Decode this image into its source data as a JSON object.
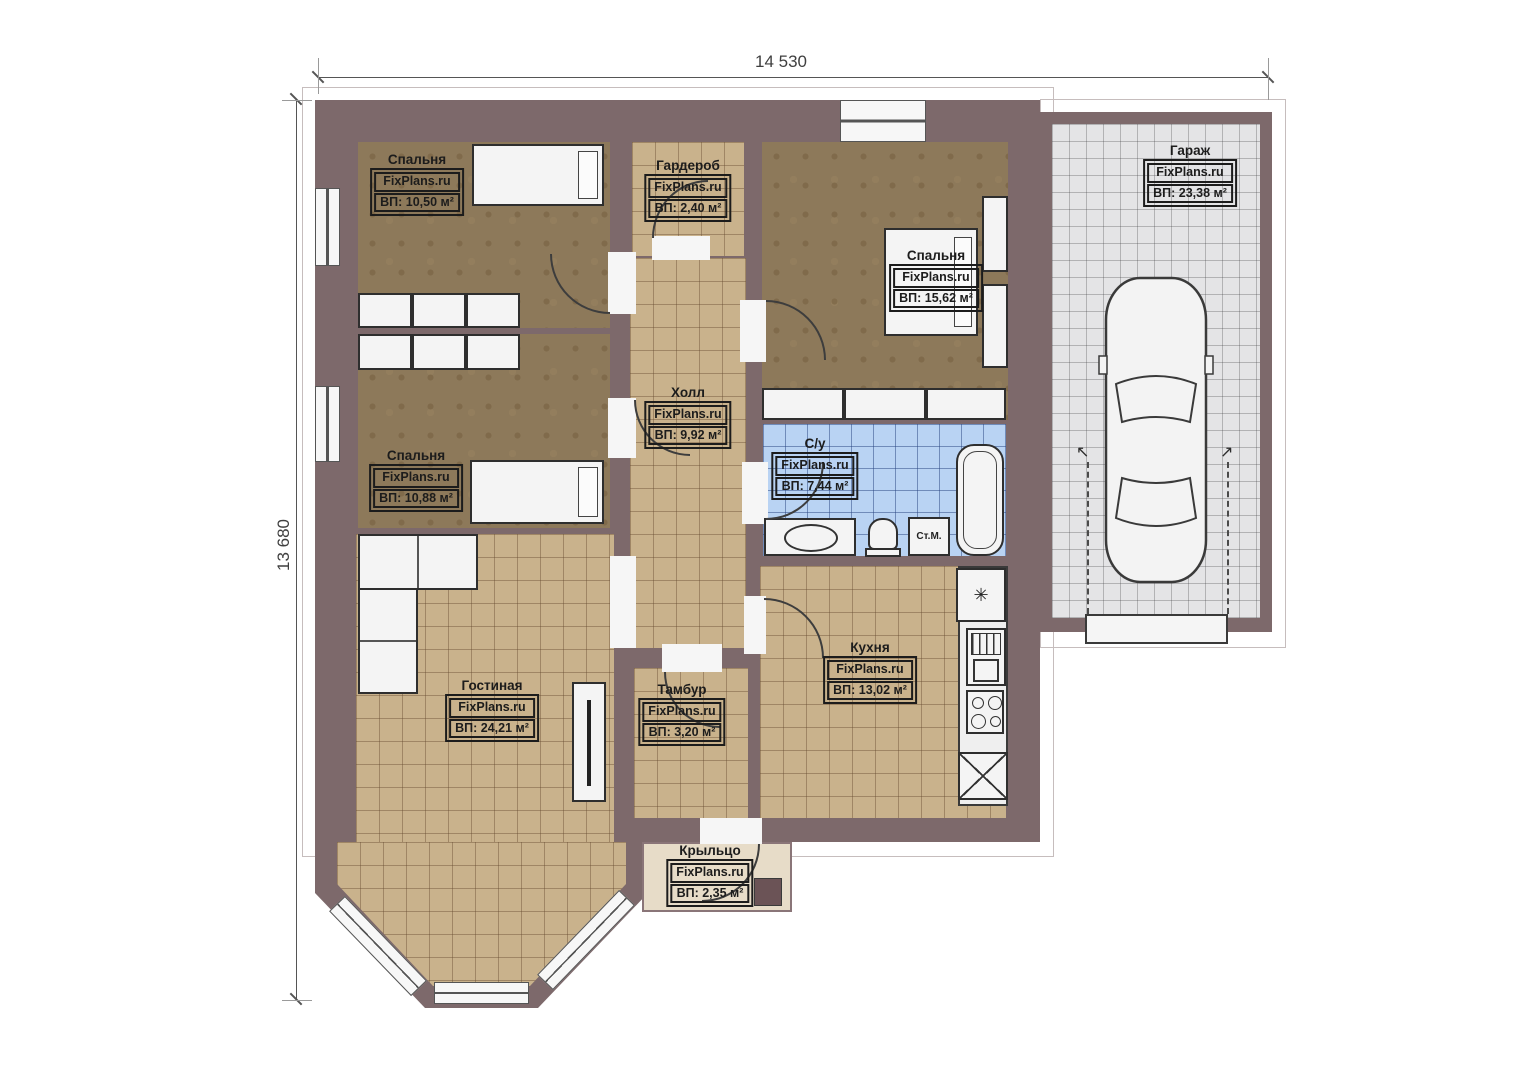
{
  "watermark": "FixPlans.ru",
  "dimension_labels": {
    "top": "14 530",
    "left": "13 680"
  },
  "rooms": [
    {
      "id": "bedroom-1",
      "name": "Спальня",
      "area": "ВП: 10,50 м²"
    },
    {
      "id": "wardrobe",
      "name": "Гардероб",
      "area": "ВП: 2,40 м²"
    },
    {
      "id": "bedroom-2",
      "name": "Спальня",
      "area": "ВП: 15,62 м²"
    },
    {
      "id": "garage",
      "name": "Гараж",
      "area": "ВП: 23,38 м²"
    },
    {
      "id": "hall",
      "name": "Холл",
      "area": "ВП: 9,92 м²"
    },
    {
      "id": "bathroom",
      "name": "С/у",
      "area": "ВП: 7,44 м²"
    },
    {
      "id": "bedroom-3",
      "name": "Спальня",
      "area": "ВП: 10,88 м²"
    },
    {
      "id": "living-room",
      "name": "Гостиная",
      "area": "ВП: 24,21 м²"
    },
    {
      "id": "vestibule",
      "name": "Тамбур",
      "area": "ВП: 3,20 м²"
    },
    {
      "id": "kitchen",
      "name": "Кухня",
      "area": "ВП: 13,02 м²"
    },
    {
      "id": "porch",
      "name": "Крыльцо",
      "area": "ВП: 2,35 м²"
    }
  ],
  "fixtures": {
    "washing_machine": "Ст.М."
  },
  "icons": {
    "fridge_snowflake": "✳",
    "swing_arrow_left": "↖",
    "swing_arrow_right": "↗"
  },
  "colors": {
    "wall": "#7d696b",
    "bedroom_floor": "#8d795a",
    "tile_floor": "#c9b28c",
    "bathroom_floor": "#b9d3f3",
    "garage_floor": "#e4e4e6",
    "porch_floor": "#e7dcc8",
    "furniture": "#f4f4f4",
    "line": "#2e2e2e"
  }
}
